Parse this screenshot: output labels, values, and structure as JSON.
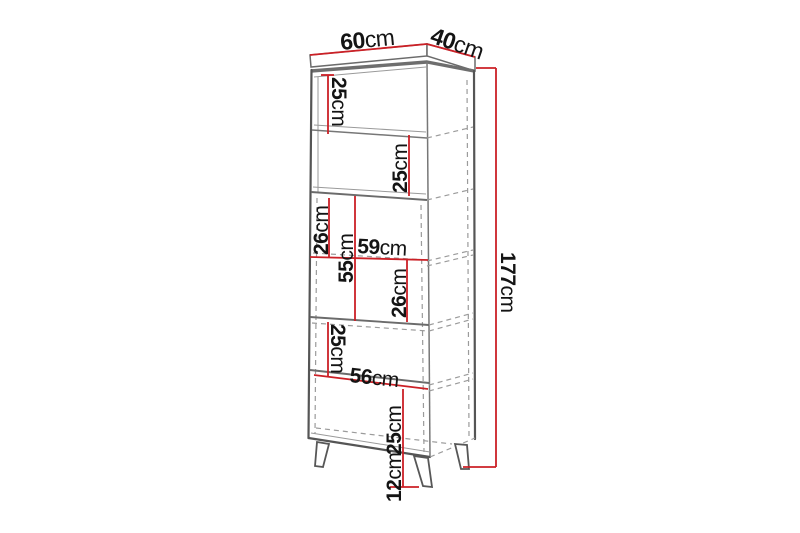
{
  "diagram": {
    "type": "furniture-dimension-diagram",
    "subject": "tall cabinet with legs",
    "colors": {
      "dimension": "#cb2026",
      "edge_dark": "#555555",
      "edge_light": "#9b9b9b",
      "background": "#ffffff",
      "text": "#141414"
    },
    "dimensions": [
      {
        "id": "top-width",
        "value": "60",
        "unit": "cm",
        "x": 341,
        "y": 50,
        "rotate": -5.5,
        "size": 23
      },
      {
        "id": "top-depth",
        "value": "40",
        "unit": "cm",
        "x": 429,
        "y": 42,
        "rotate": 19,
        "size": 23
      },
      {
        "id": "total-height",
        "value": "177",
        "unit": "cm",
        "x": 501,
        "y": 252,
        "rotate": 90,
        "size": 21
      },
      {
        "id": "niche-1-height",
        "value": "25",
        "unit": "cm",
        "x": 332,
        "y": 77,
        "rotate": 90,
        "size": 21
      },
      {
        "id": "niche-2-height",
        "value": "25",
        "unit": "cm",
        "x": 407,
        "y": 193,
        "rotate": -90,
        "size": 21
      },
      {
        "id": "compartment-upper-height",
        "value": "26",
        "unit": "cm",
        "x": 328,
        "y": 255,
        "rotate": -90,
        "size": 21
      },
      {
        "id": "door-section-height",
        "value": "55",
        "unit": "cm",
        "x": 353,
        "y": 283,
        "rotate": -90,
        "size": 21
      },
      {
        "id": "inner-width-upper",
        "value": "59",
        "unit": "cm",
        "x": 357,
        "y": 253,
        "rotate": 3,
        "size": 21
      },
      {
        "id": "compartment-lower-height",
        "value": "26",
        "unit": "cm",
        "x": 406,
        "y": 318,
        "rotate": -90,
        "size": 21
      },
      {
        "id": "shelf-section-height",
        "value": "25",
        "unit": "cm",
        "x": 331,
        "y": 324,
        "rotate": 90,
        "size": 21
      },
      {
        "id": "inner-width-lower",
        "value": "56",
        "unit": "cm",
        "x": 349,
        "y": 382,
        "rotate": 6,
        "size": 21
      },
      {
        "id": "base-section-height",
        "value": "25",
        "unit": "cm",
        "x": 401,
        "y": 455,
        "rotate": -90,
        "size": 21
      },
      {
        "id": "leg-height",
        "value": "12",
        "unit": "cm",
        "x": 401,
        "y": 502,
        "rotate": -90,
        "size": 21
      }
    ]
  }
}
